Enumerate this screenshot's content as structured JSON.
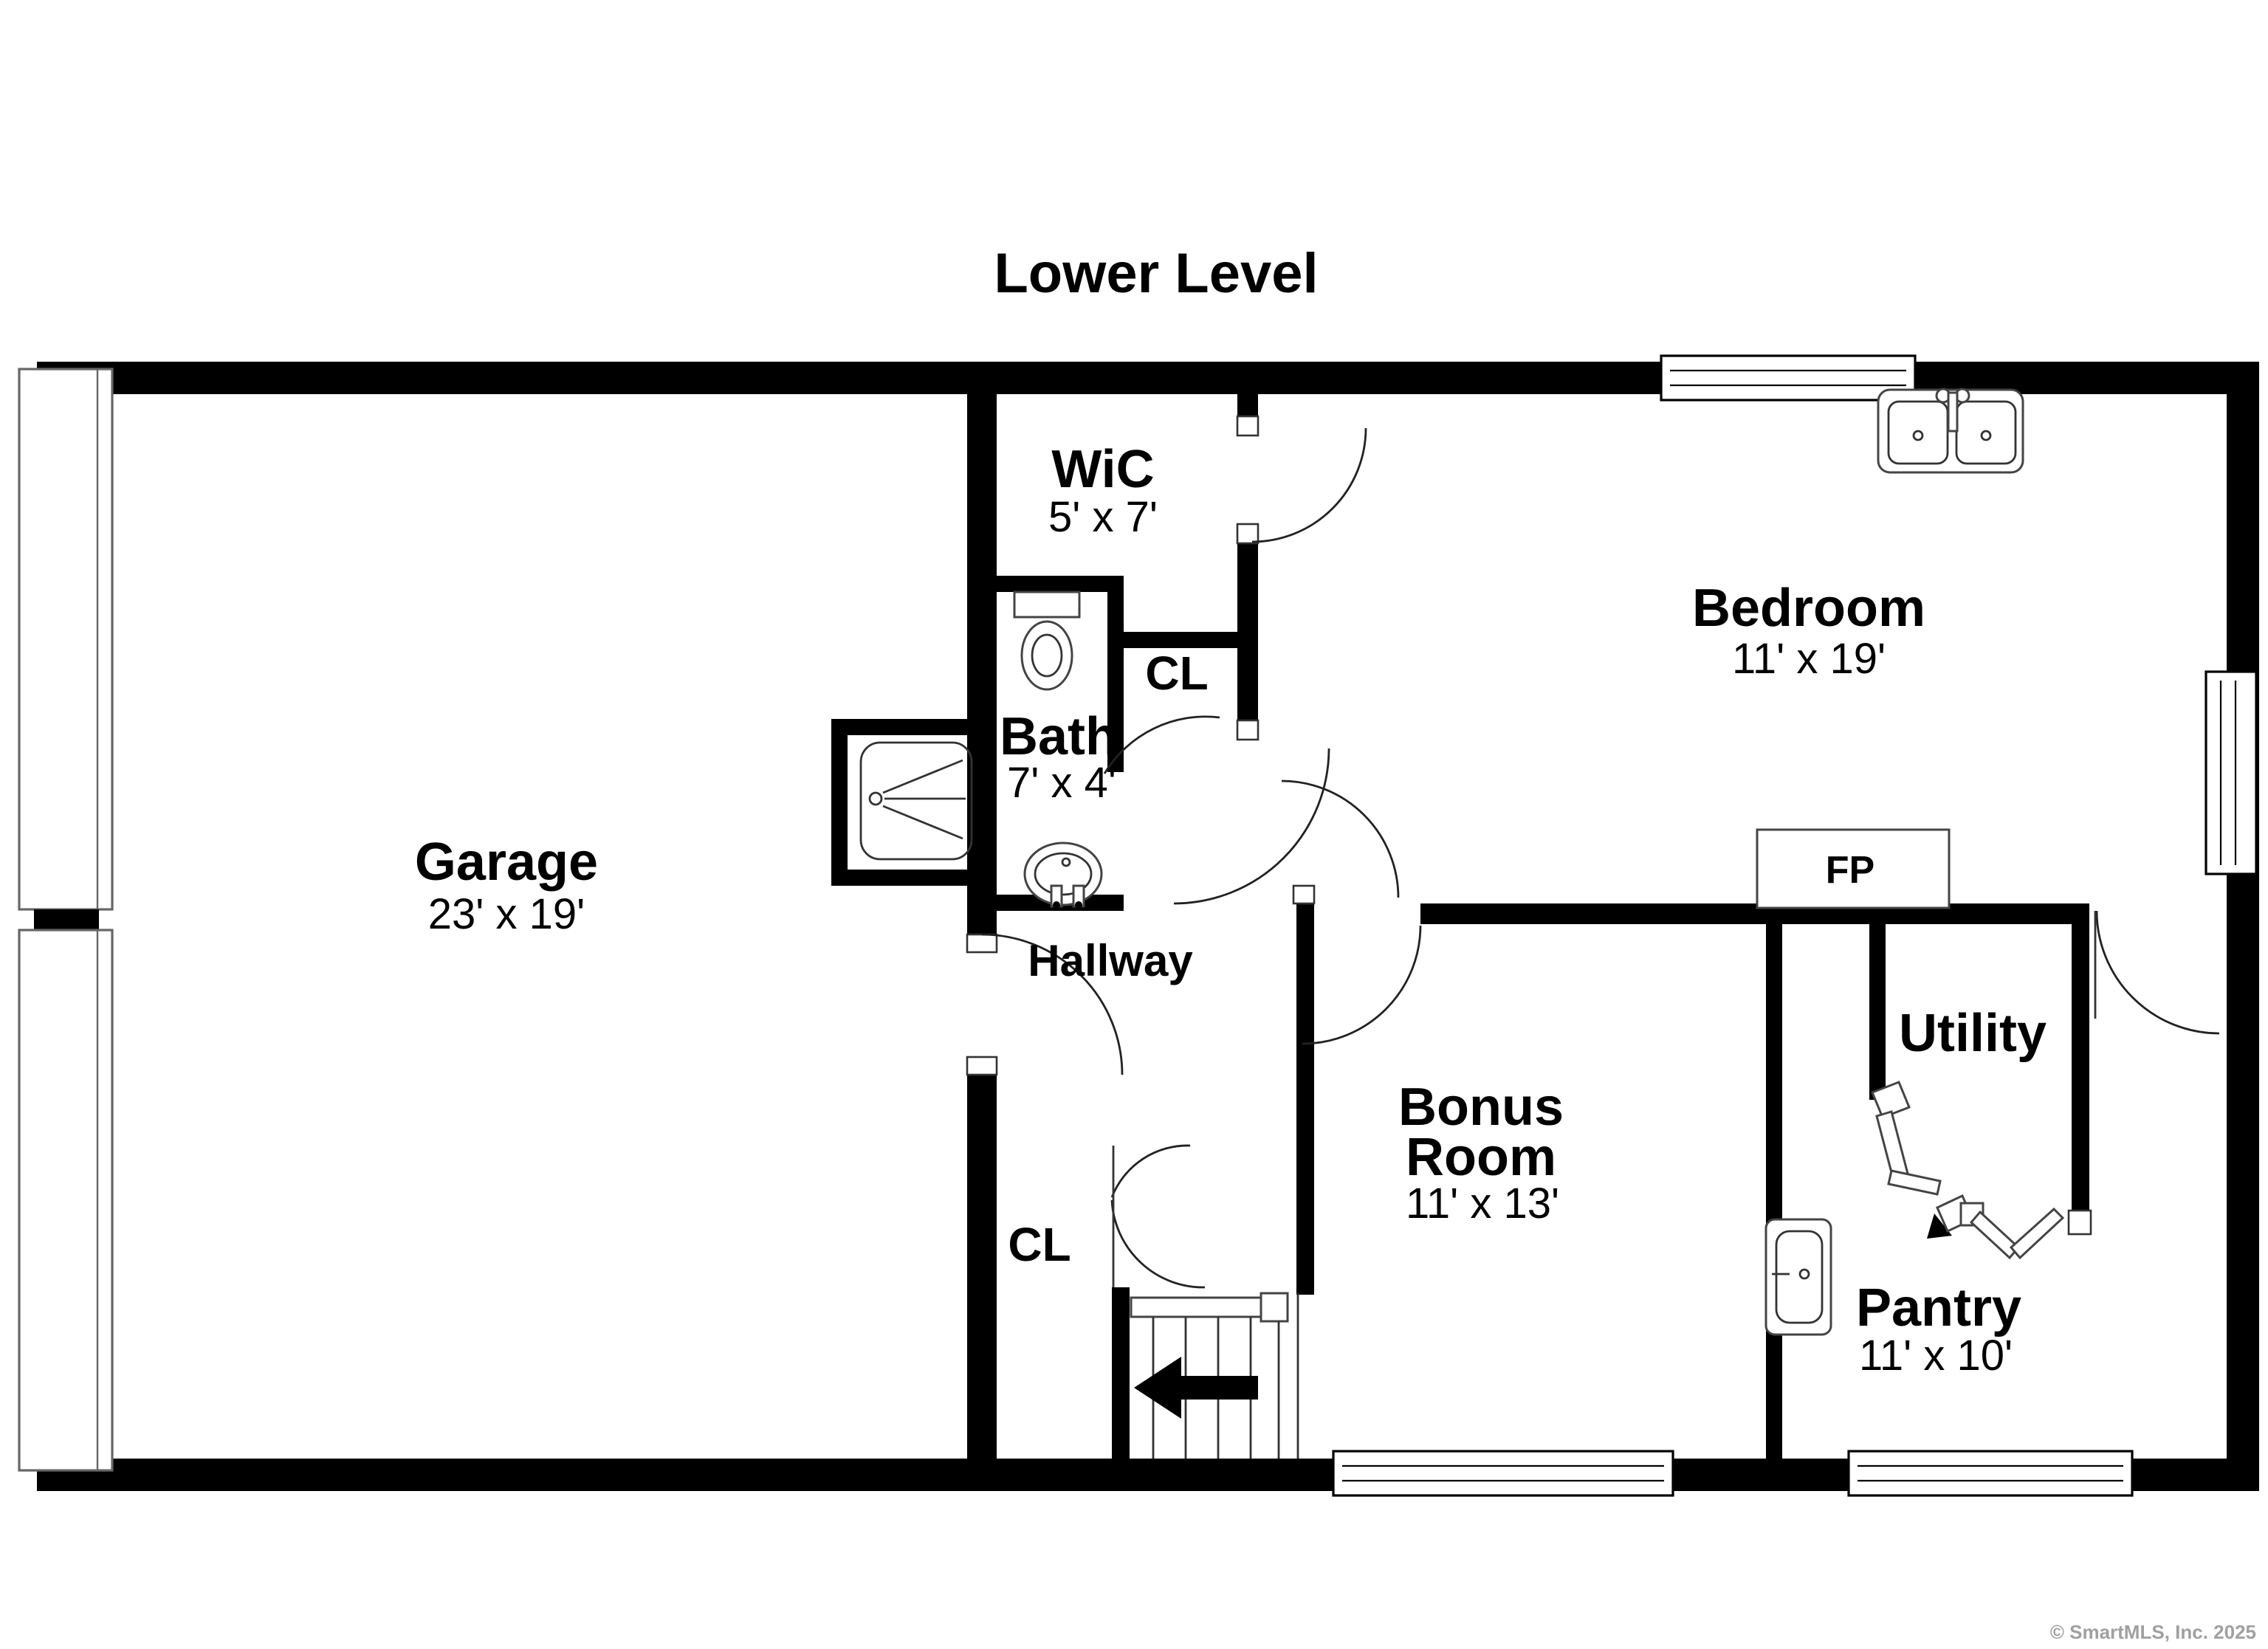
{
  "title": "Lower Level",
  "watermark": "© SmartMLS, Inc. 2025",
  "colors": {
    "walls": "#000000",
    "background": "#ffffff",
    "fixture_outline": "#444444",
    "watermark": "#a0a0a0"
  },
  "rooms": {
    "garage": {
      "name": "Garage",
      "dims": "23' x 19'"
    },
    "wic": {
      "name": "WiC",
      "dims": "5' x 7'"
    },
    "bath": {
      "name": "Bath",
      "dims": "7' x 4'"
    },
    "cl_upper": {
      "name": "CL"
    },
    "bedroom": {
      "name": "Bedroom",
      "dims": "11' x 19'"
    },
    "hallway": {
      "name": "Hallway"
    },
    "bonus_room": {
      "line1": "Bonus",
      "line2": "Room",
      "dims": "11' x 13'"
    },
    "cl_lower": {
      "name": "CL"
    },
    "utility": {
      "name": "Utility"
    },
    "pantry": {
      "name": "Pantry",
      "dims": "11' x 10'"
    },
    "fireplace": {
      "name": "FP"
    }
  }
}
